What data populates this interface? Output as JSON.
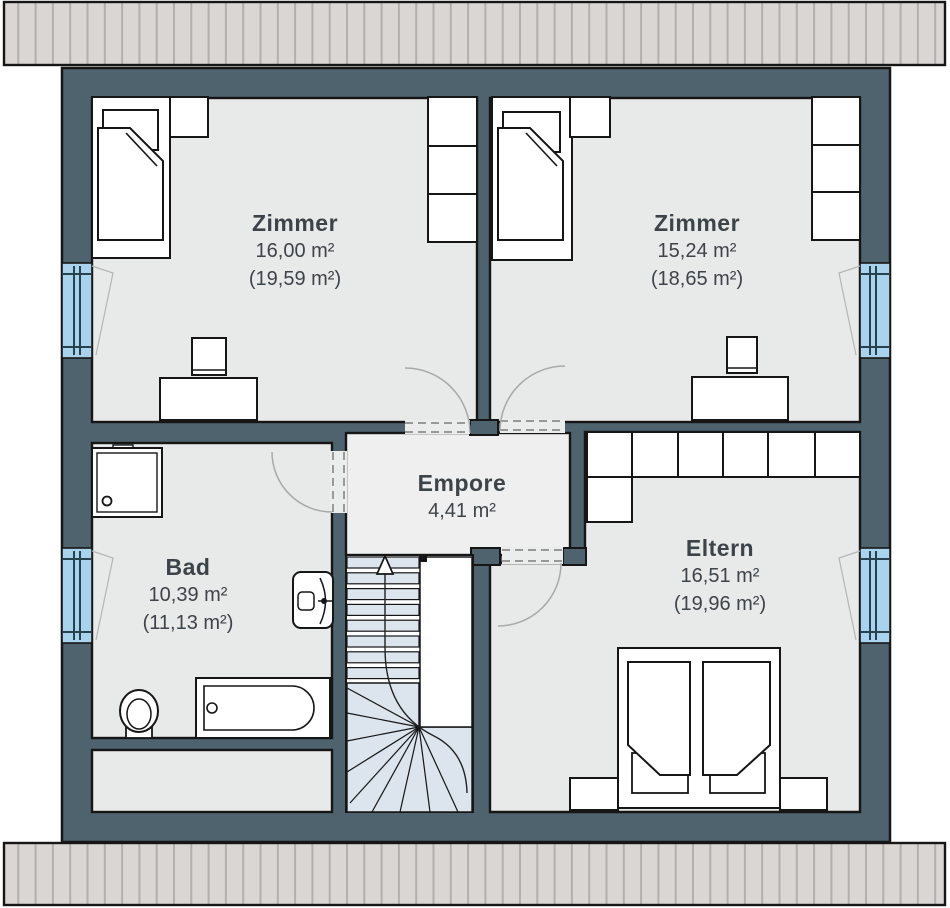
{
  "plan": {
    "floor_type": "floorplan",
    "rooms": {
      "zimmer_left": {
        "name": "Zimmer",
        "area": "16,00 m²",
        "area_gross": "(19,59 m²)"
      },
      "zimmer_right": {
        "name": "Zimmer",
        "area": "15,24 m²",
        "area_gross": "(18,65 m²)"
      },
      "empore": {
        "name": "Empore",
        "area": "4,41 m²"
      },
      "bad": {
        "name": "Bad",
        "area": "10,39 m²",
        "area_gross": "(11,13 m²)"
      },
      "eltern": {
        "name": "Eltern",
        "area": "16,51 m²",
        "area_gross": "(19,96 m²)"
      }
    },
    "colors": {
      "wall": "#4f636e",
      "room_floor": "#e8e9e9",
      "hall_floor": "#efefef",
      "window_glass": "#a9d2ec",
      "stair_tread": "#dce4ee",
      "roof": "#dad6d4",
      "outline": "#161616",
      "label_text": "#3d4449"
    }
  }
}
